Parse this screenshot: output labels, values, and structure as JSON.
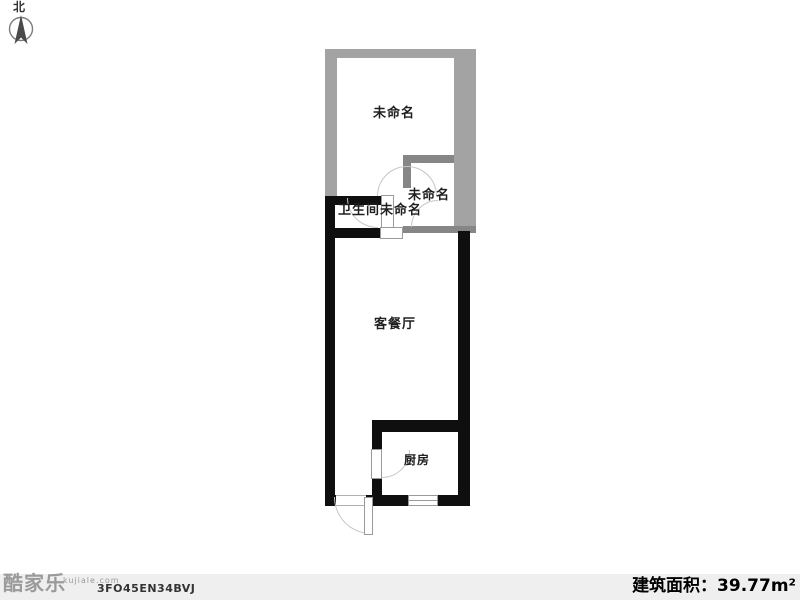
{
  "compass": {
    "north_label": "北"
  },
  "floor_plan": {
    "rooms": [
      {
        "id": "room-unnamed-top",
        "label": "未命名"
      },
      {
        "id": "room-unnamed-small",
        "label": "未命名"
      },
      {
        "id": "room-bathroom",
        "label": "卫生间"
      },
      {
        "id": "room-passage",
        "label": "未命名"
      },
      {
        "id": "room-living-dining",
        "label": "客餐厅"
      },
      {
        "id": "room-kitchen",
        "label": "厨房"
      }
    ]
  },
  "footer": {
    "brand": "酷家乐",
    "brand_domain": "kujiale.com",
    "plan_code": "3FO45EN34BVJ",
    "area_text": "建筑面积：39.77m²"
  },
  "colors": {
    "outer_wall_gray": "#a3a3a3",
    "inner_wall_gray": "#868686",
    "wall_black": "#0f0f0f",
    "footer_bg": "#efefef",
    "label_text": "#1f1f1f"
  }
}
